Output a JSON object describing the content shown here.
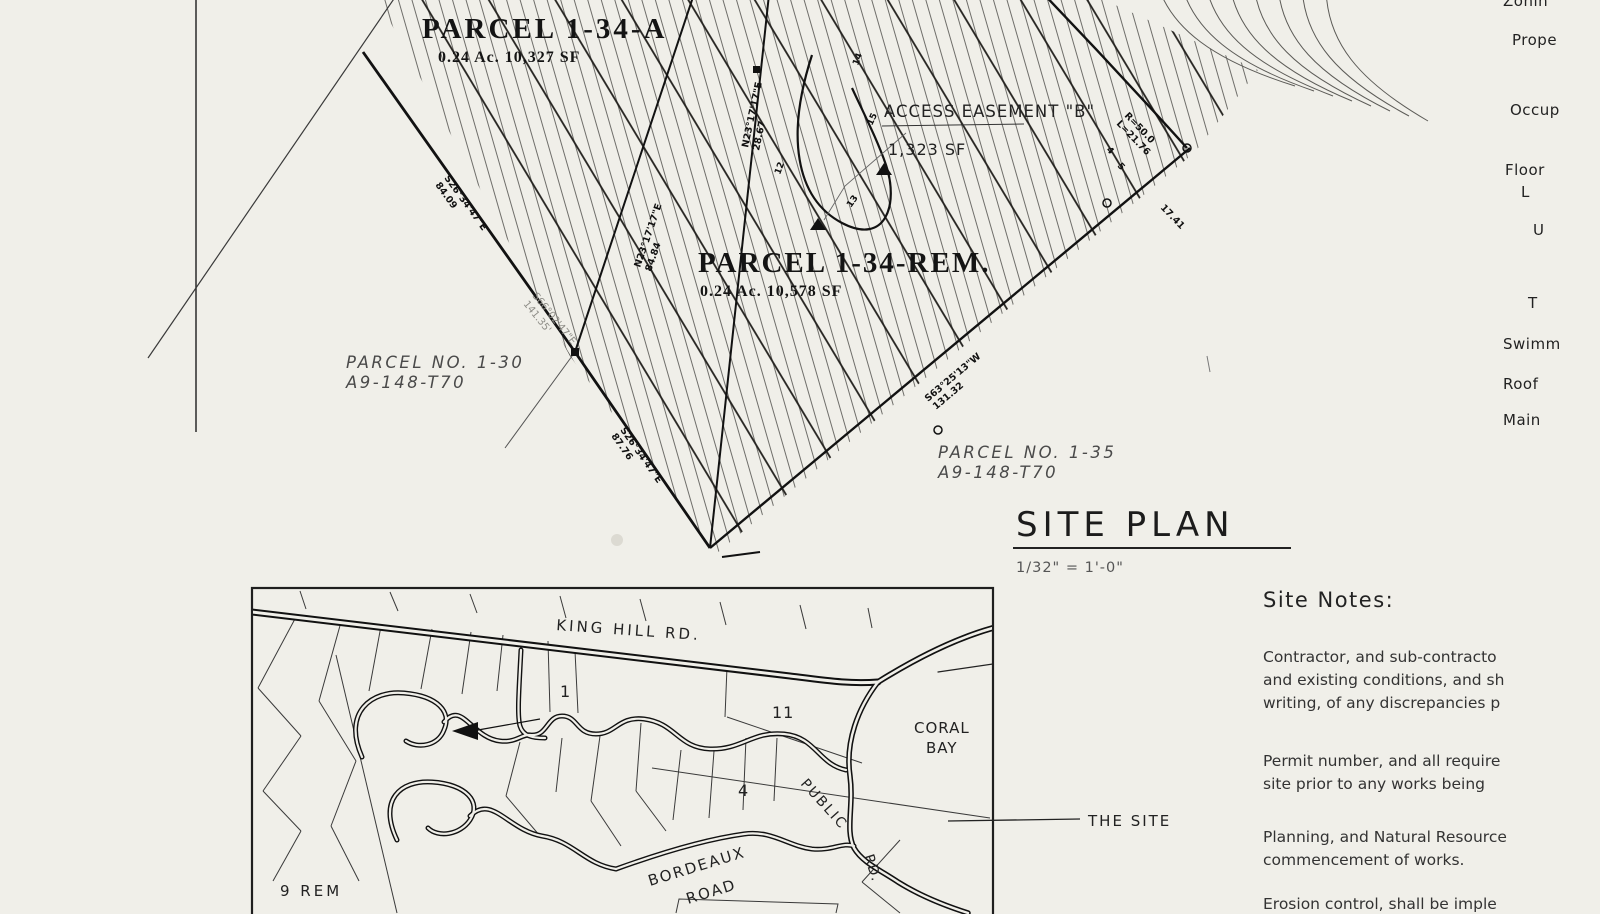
{
  "colors": {
    "paper": "#f0efe9",
    "ink": "#1a1a1a",
    "light_ink": "#8d8c86"
  },
  "site_plan": {
    "parcel_a_name": "PARCEL 1-34-A",
    "parcel_a_area": "0.24 Ac. 10,327 SF",
    "parcel_rem_name": "PARCEL 1-34-REM.",
    "parcel_rem_area": "0.24 Ac. 10,578 SF",
    "easement_name": "ACCESS EASEMENT \"B\"",
    "easement_area": "1,323 SF",
    "parcel_30_name": "PARCEL NO. 1-30",
    "parcel_30_ref": "A9-148-T70",
    "parcel_35_name": "PARCEL NO. 1-35",
    "parcel_35_ref": "A9-148-T70",
    "title": "SITE PLAN",
    "scale": "1/32\" = 1'-0\"",
    "bearings": [
      {
        "l1": "S26°34'47\"E",
        "l2": "84.09"
      },
      {
        "l1": "S66°02'47\"E",
        "l2": "141.35'"
      },
      {
        "l1": "N23°17'17\"E",
        "l2": "84.84"
      },
      {
        "l1": "N23°17'17\"E",
        "l2": "28.67"
      },
      {
        "l1": "R=50.0",
        "l2": "L=21.76"
      },
      {
        "l1": "17.41",
        "l2": ""
      },
      {
        "l1": "S63°25'13\"W",
        "l2": "131.32"
      },
      {
        "l1": "S26°34'47\"E",
        "l2": "87.76"
      }
    ],
    "contour_labels": [
      {
        "t": "12"
      },
      {
        "t": "13"
      },
      {
        "t": "14"
      },
      {
        "t": "15"
      },
      {
        "t": "4"
      },
      {
        "t": "5"
      }
    ]
  },
  "location_map": {
    "king_hill_rd": "KING HILL RD.",
    "lot_1": "1",
    "lot_11": "11",
    "lot_4": "4",
    "lot_9_rem": "9 REM",
    "coral_bay_line1": "CORAL",
    "coral_bay_line2": "BAY",
    "bordeaux_line1": "BORDEAUX",
    "bordeaux_line2": "ROAD",
    "public": "PUBLIC",
    "public_rd_suffix": "RD.",
    "the_site": "THE SITE"
  },
  "notes": {
    "heading": "Site Notes:",
    "p1l1": "Contractor, and sub-contracto",
    "p1l2": "and existing conditions, and sh",
    "p1l3": "writing, of any discrepancies p",
    "p2l1": "Permit number, and all require",
    "p2l2": "site prior to any works being",
    "p3l1": "Planning, and Natural Resource",
    "p3l2": "commencement of works.",
    "p4l1": "Erosion control, shall be imple"
  },
  "right_labels": {
    "zoning": "Zonin",
    "proposed": "Prope",
    "occupancy": "Occup",
    "floor": "Floor",
    "l": "L",
    "u": "U",
    "t": "T",
    "swimming": "Swimm",
    "roof": "Roof",
    "main": "Main"
  }
}
